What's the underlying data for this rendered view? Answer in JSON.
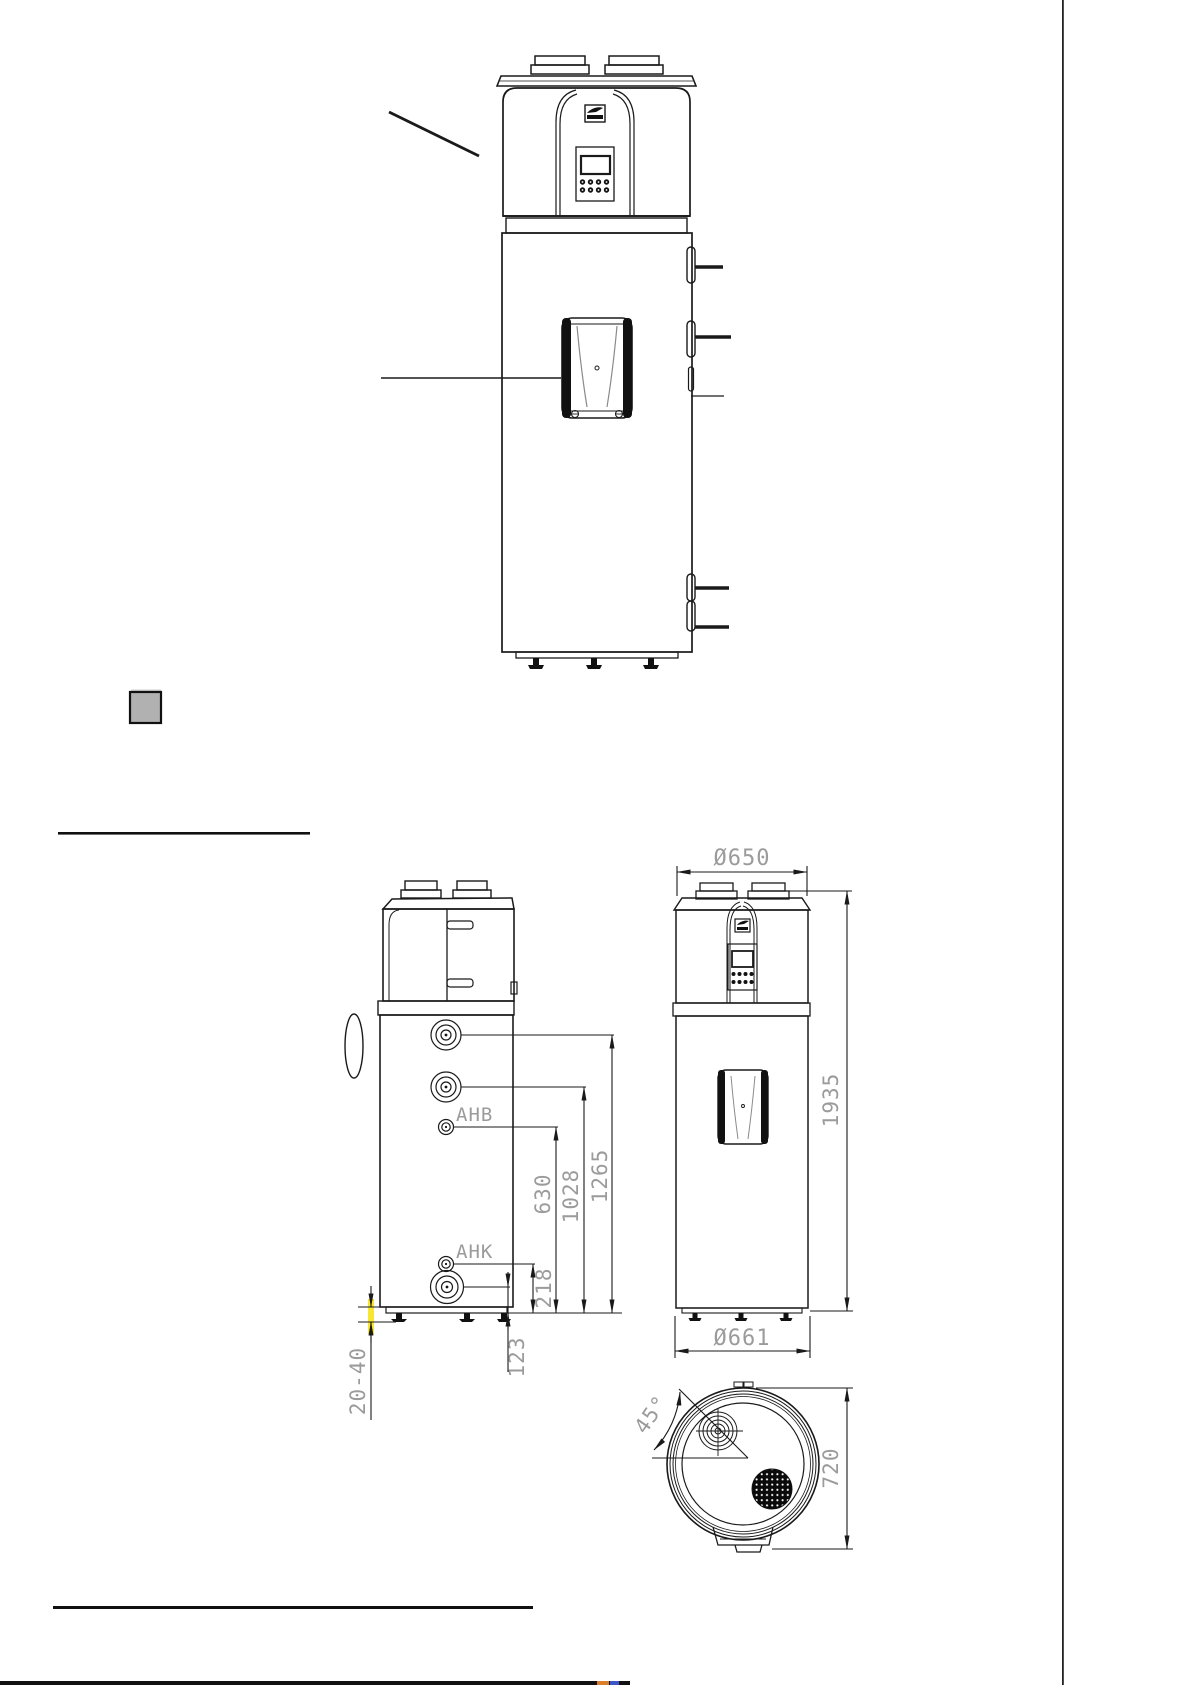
{
  "palette": {
    "line": "#1a1a1a",
    "dim_text": "#9b9b9b",
    "highlight_yellow": "#f7e733",
    "legend_gray": "#b1b1b1",
    "accent_orange": "#d97f2e",
    "accent_blue": "#3c55c8"
  },
  "labels": {
    "side_view": {
      "ahb": "AHB",
      "ahk": "AHK",
      "h1265": "1265",
      "h1028": "1028",
      "h630": "630",
      "h218": "218",
      "h123": "123",
      "foot_range": "20-40"
    },
    "front_view": {
      "top_diameter": "Ø650",
      "height": "1935",
      "base_diameter": "Ø661"
    },
    "top_view": {
      "angle": "45°",
      "depth": "720"
    }
  }
}
